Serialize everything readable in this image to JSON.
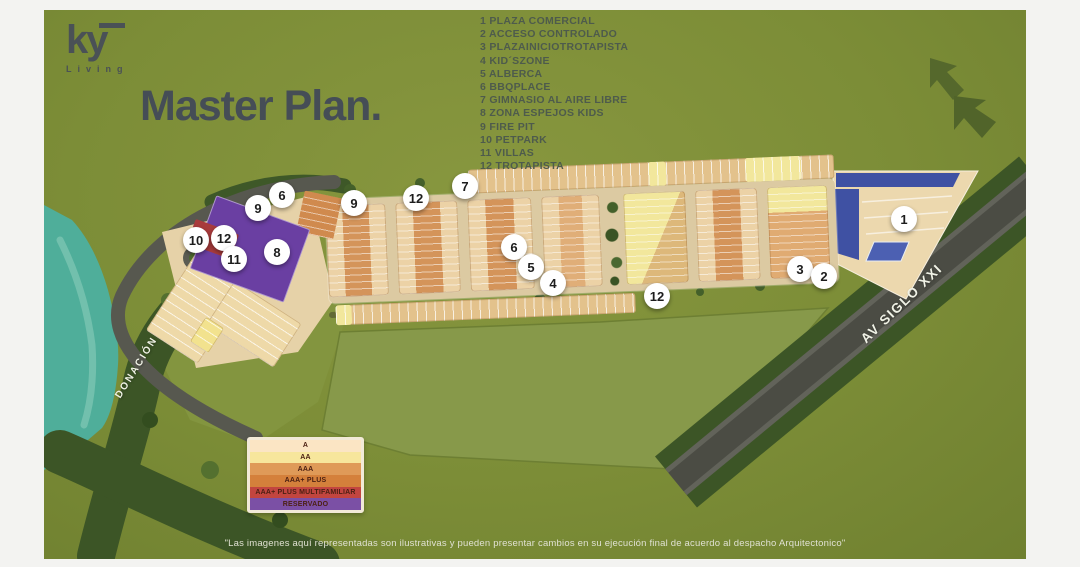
{
  "brand": {
    "logo_text": "ky",
    "logo_sub": "Living"
  },
  "title": "Master Plan.",
  "amenities": [
    {
      "num": "1",
      "label": "PLAZA COMERCIAL"
    },
    {
      "num": "2",
      "label": "ACCESO CONTROLADO"
    },
    {
      "num": "3",
      "label": "PLAZAINICIOTROTAPISTA"
    },
    {
      "num": "4",
      "label": "KID´SZONE"
    },
    {
      "num": "5",
      "label": "ALBERCA"
    },
    {
      "num": "6",
      "label": "BBQPLACE"
    },
    {
      "num": "7",
      "label": "GIMNASIO AL AIRE LIBRE"
    },
    {
      "num": "8",
      "label": "ZONA ESPEJOS KIDS"
    },
    {
      "num": "9",
      "label": "FIRE PIT"
    },
    {
      "num": "10",
      "label": "PETPARK"
    },
    {
      "num": "11",
      "label": "VILLAS"
    },
    {
      "num": "12",
      "label": "TROTAPISTA"
    }
  ],
  "categories": [
    {
      "label": "A",
      "color": "#fbe5c4"
    },
    {
      "label": "AA",
      "color": "#f7e69c"
    },
    {
      "label": "AAA",
      "color": "#df9a58"
    },
    {
      "label": "AAA+ PLUS",
      "color": "#d4803b"
    },
    {
      "label": "AAA+ PLUS MULTIFAMILIAR",
      "color": "#c2453f"
    },
    {
      "label": "RESERVADO",
      "color": "#7b50a5"
    }
  ],
  "map": {
    "area_label": "DONACIÓN",
    "road_label": "AV SIGLO XXI",
    "markers": [
      {
        "n": "6",
        "x": 282,
        "y": 195
      },
      {
        "n": "9",
        "x": 258,
        "y": 208
      },
      {
        "n": "10",
        "x": 196,
        "y": 240
      },
      {
        "n": "12",
        "x": 224,
        "y": 238
      },
      {
        "n": "11",
        "x": 234,
        "y": 259
      },
      {
        "n": "8",
        "x": 277,
        "y": 252
      },
      {
        "n": "9",
        "x": 354,
        "y": 203
      },
      {
        "n": "12",
        "x": 416,
        "y": 198
      },
      {
        "n": "7",
        "x": 465,
        "y": 186
      },
      {
        "n": "6",
        "x": 514,
        "y": 247
      },
      {
        "n": "5",
        "x": 531,
        "y": 267
      },
      {
        "n": "4",
        "x": 553,
        "y": 283
      },
      {
        "n": "12",
        "x": 657,
        "y": 296
      },
      {
        "n": "3",
        "x": 800,
        "y": 269
      },
      {
        "n": "2",
        "x": 824,
        "y": 276
      },
      {
        "n": "1",
        "x": 904,
        "y": 219
      }
    ]
  },
  "colors": {
    "background_green": "#7c8d37",
    "title_gray": "#454d56",
    "water_teal": "#4fae9a",
    "reserved_purple": "#6a3fa2",
    "commercial_blue": "#3f51a3"
  },
  "disclaimer": "\"Las imagenes aquí representadas son ilustrativas y pueden presentar cambios en su ejecución final de acuerdo al despacho Arquitectonico\""
}
